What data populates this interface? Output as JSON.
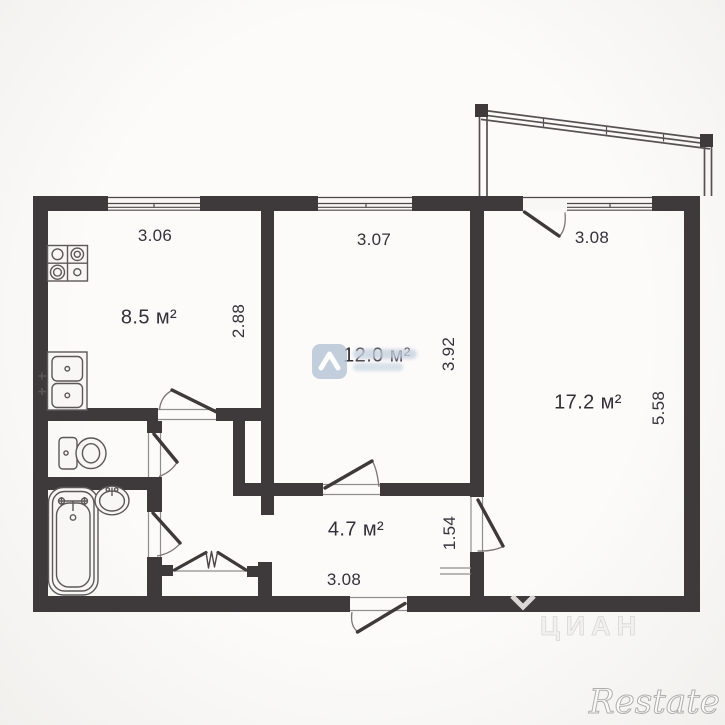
{
  "plan": {
    "type": "apartment-floorplan",
    "rooms": [
      {
        "key": "kitchen",
        "area": "8.5 м²"
      },
      {
        "key": "living-room",
        "area": "12.0 м²"
      },
      {
        "key": "bedroom",
        "area": "17.2 м²"
      },
      {
        "key": "hallway",
        "area": "4.7 м²"
      }
    ],
    "dims": {
      "kitchen_w": "3.06",
      "kitchen_h": "2.88",
      "living_w": "3.07",
      "living_h": "3.92",
      "bedroom_w": "3.08",
      "bedroom_h": "5.58",
      "hall_w": "3.08",
      "hall_h": "1.54"
    },
    "fixtures": [
      "stove-icon",
      "kitchen-sink-icon",
      "toilet-icon",
      "bathtub-icon",
      "washbasin-icon",
      "balcony-railing-icon",
      "window-icon",
      "door-swing-icon",
      "folding-door-icon"
    ]
  },
  "watermarks": {
    "agency_logo": "alliance-logo-icon",
    "cian": "ЦИАН",
    "restate": "Restate"
  },
  "colors": {
    "wall": "#3e3a3c",
    "fixture_line": "#5c585a",
    "logo_blue": "#b6c4d6",
    "ghost_gray": "#d9d7d5"
  }
}
